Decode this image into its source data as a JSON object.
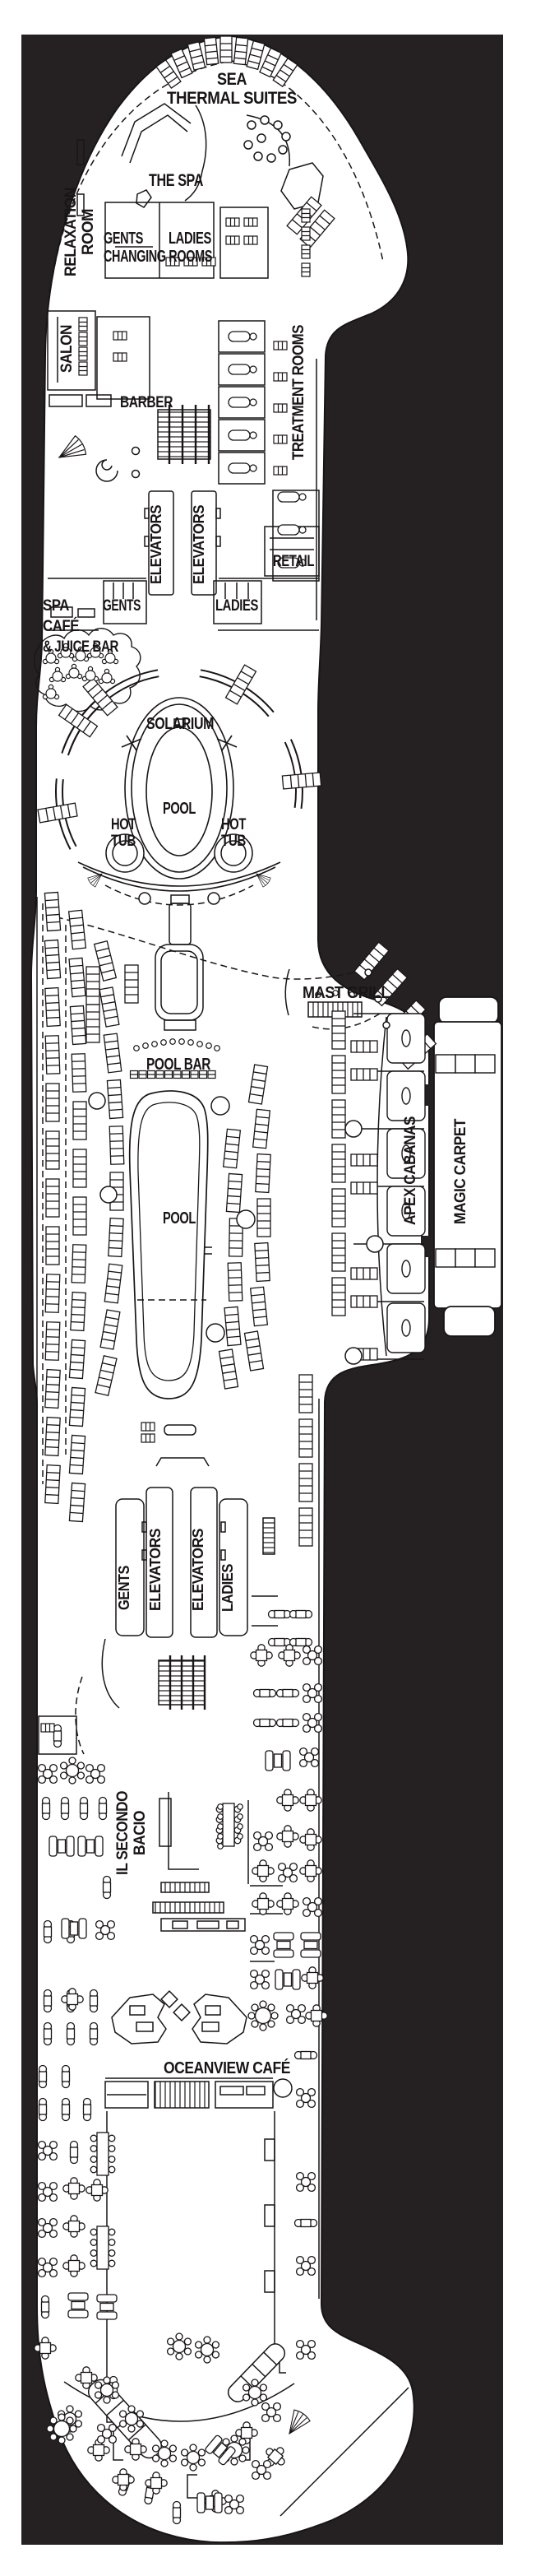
{
  "plan_title": "Ship Deck Plan - Spa, Pool and Oceanview Cafe Deck",
  "colors": {
    "background": "#252122",
    "paper": "#ffffff",
    "line": "#191516"
  },
  "labels": {
    "sea_thermal_suites_line1": "SEA",
    "sea_thermal_suites_line2": "THERMAL SUITES",
    "the_spa": "THE SPA",
    "relaxation_room_line1": "RELAXATION",
    "relaxation_room_line2": "ROOM",
    "changing_gents": "GENTS",
    "changing_ladies": "LADIES",
    "changing_rooms": "CHANGING ROOMS",
    "salon": "SALON",
    "barber": "BARBER",
    "treatment_rooms": "TREATMENT ROOMS",
    "elevators": "ELEVATORS",
    "retail": "RETAIL",
    "gents": "GENTS",
    "ladies": "LADIES",
    "spa_cafe_line1": "SPA",
    "spa_cafe_line2": "CAFÉ",
    "spa_cafe_line3": "& JUICE BAR",
    "solarium": "SOLARIUM",
    "pool": "POOL",
    "hot_tub_line1": "HOT",
    "hot_tub_line2": "TUB",
    "mast_grill": "MAST GRILL",
    "pool_bar": "POOL BAR",
    "apex_cabanas": "APEX CABANAS",
    "magic_carpet": "MAGIC CARPET",
    "il_secondo_bacio_line1": "IL SECONDO",
    "il_secondo_bacio_line2": "BACIO",
    "oceanview_cafe": "OCEANVIEW CAFÉ"
  }
}
